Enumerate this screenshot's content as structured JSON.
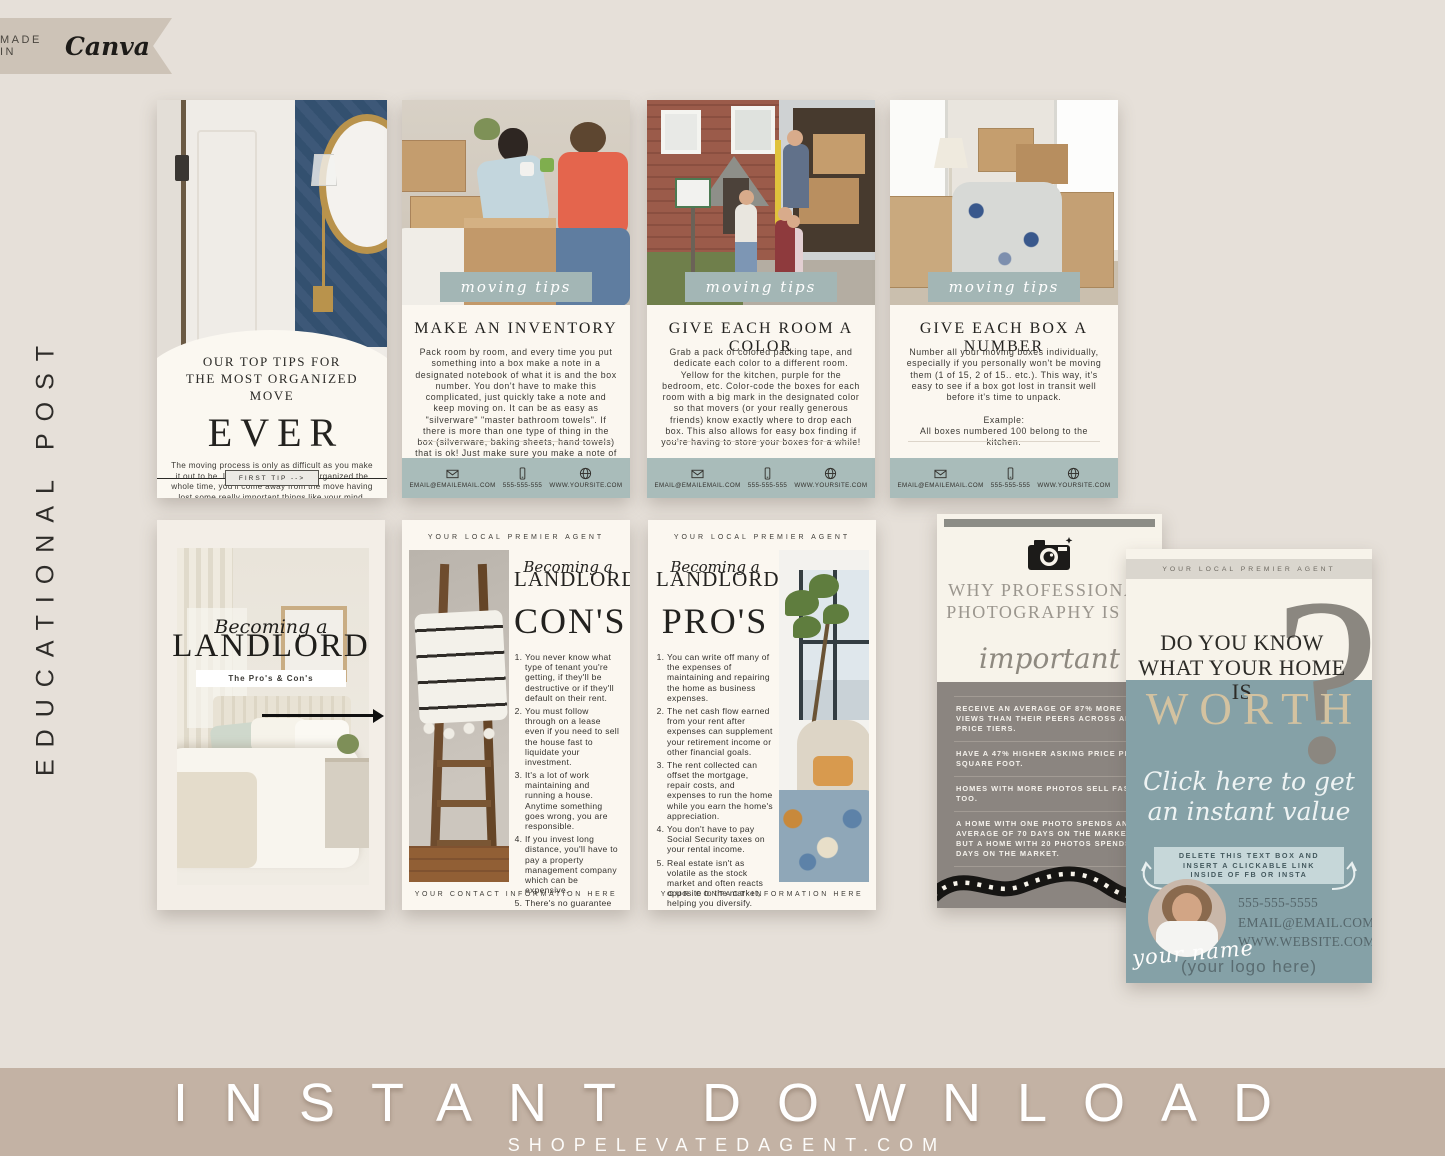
{
  "badge": {
    "prefix": "MADE IN",
    "brand": "Canva"
  },
  "side_label": "EDUCATIONAL POST",
  "bottom_banner": {
    "title": "INSTANT DOWNLOAD",
    "site": "SHOPELEVATEDAGENT.COM"
  },
  "colors": {
    "page_bg": "#e6e0d9",
    "banner_bg": "#c3b2a4",
    "sage": "#a3b6b5",
    "footer_sage": "#a9bcba",
    "cream": "#fbf7f0",
    "photo_gray": "#8b8580",
    "teal": "#85a1a7",
    "tan_word": "#d3c2a0"
  },
  "cover_card": {
    "title_line1": "OUR TOP TIPS FOR",
    "title_line2": "THE MOST ORGANIZED MOVE",
    "big_word": "EVER",
    "body": "The moving process is only as difficult as you make it out to be. If you're hangry and disorganized the whole time, you'll come away from the move having lost some really important things like your mind, your time, and your grandmother's china.",
    "button": "FIRST TIP -->"
  },
  "tip_cards": [
    {
      "banner": "moving tips",
      "heading": "MAKE AN INVENTORY",
      "body": "Pack room by room, and every time you put something into a box make a note in a designated notebook of what it is and the box number. You don't have to make this complicated, just quickly take a note and keep moving on. It can be as easy as \"silverware\" \"master bathroom towels\". If there is more than one type of thing in the box (silverware, baking sheets, hand towels) that is ok! Just make sure you make a note of everything."
    },
    {
      "banner": "moving tips",
      "heading": "GIVE EACH ROOM A COLOR",
      "body": "Grab a pack of colored packing tape, and dedicate each color to a different room. Yellow for the kitchen, purple for the bedroom, etc. Color-code the boxes for each room with a big mark in the designated color so that movers (or your really generous friends) know exactly where to drop each box. This also allows for easy box finding if you're having to store your boxes for a while!"
    },
    {
      "banner": "moving tips",
      "heading": "GIVE EACH BOX A NUMBER",
      "body": "Number all your moving boxes individually, especially if you personally won't be moving them (1 of 15, 2 of 15.. etc.). This way, it's easy to see if a box got lost in transit well before it's time to unpack.",
      "example_label": "Example:",
      "example": "All boxes numbered 100 belong to the kitchen."
    }
  ],
  "contact_strip": {
    "email": "EMAIL@EMAILEMAIL.COM",
    "phone": "555-555-555",
    "website": "WWW.YOURSITE.COM"
  },
  "landlord_cover": {
    "script": "Becoming a",
    "word": "LANDLORD",
    "subtitle": "The Pro's & Con's"
  },
  "landlord_cons": {
    "header": "YOUR LOCAL PREMIER AGENT",
    "script": "Becoming a",
    "word": "LANDLORD",
    "big": "CON'S",
    "items": [
      "You never know what type of tenant you're getting, if they'll be destructive or if they'll default on their rent.",
      "You must follow through on a lease even if you need to sell the house fast to liquidate your investment.",
      "It's a lot of work maintaining and running a house. Anytime something goes wrong, you are responsible.",
      "If you invest long distance, you'll have to pay a property management company which can be expensive.",
      "There's no guarantee your investment will appreciate."
    ],
    "footer": "YOUR CONTACT INFORMATION HERE"
  },
  "landlord_pros": {
    "header": "YOUR LOCAL PREMIER AGENT",
    "script": "Becoming a",
    "word": "LANDLORD",
    "big": "PRO'S",
    "items": [
      "You can write off many of the expenses of maintaining and repairing the home as business expenses.",
      "The net cash flow earned from your rent after expenses can supplement your retirement income or other financial goals.",
      "The rent collected can offset the mortgage, repair costs, and expenses to run the home while you earn the home's appreciation.",
      "You don't have to pay Social Security taxes on your rental income.",
      "Real estate isn't as volatile as the stock market and often reacts opposite to the market, helping you diversify."
    ],
    "footer": "YOUR CONTACT INFORMATION HERE"
  },
  "photography_card": {
    "title": "WHY PROFESSIONAL PHOTOGRAPHY IS SO",
    "script": "important",
    "stats": [
      "RECEIVE AN AVERAGE OF 87% MORE VIEWS THAN THEIR PEERS ACROSS ALL PRICE TIERS.",
      "HAVE A 47% HIGHER ASKING PRICE PER SQUARE FOOT.",
      "HOMES WITH MORE PHOTOS SELL FASTER, TOO.",
      "A HOME WITH ONE PHOTO SPENDS AN AVERAGE OF 70 DAYS ON THE MARKET, BUT A HOME WITH 20 PHOTOS SPENDS 32 DAYS ON THE MARKET."
    ]
  },
  "worth_card": {
    "header": "YOUR LOCAL PREMIER AGENT",
    "title_line1": "DO YOU KNOW",
    "title_line2": "WHAT YOUR HOME IS",
    "big_word": "WORTH",
    "question_mark": "?",
    "script_line1": "Click here to get",
    "script_line2": "an instant value",
    "note_line1": "DELETE THIS TEXT BOX AND",
    "note_line2": "INSERT A CLICKABLE LINK",
    "note_line3": "INSIDE OF FB OR INSTA",
    "name_script": "your name",
    "phone": "555-555-5555",
    "email": "EMAIL@EMAIL.COM",
    "website": "WWW.WEBSITE.COM",
    "logo": "(your logo here)"
  }
}
